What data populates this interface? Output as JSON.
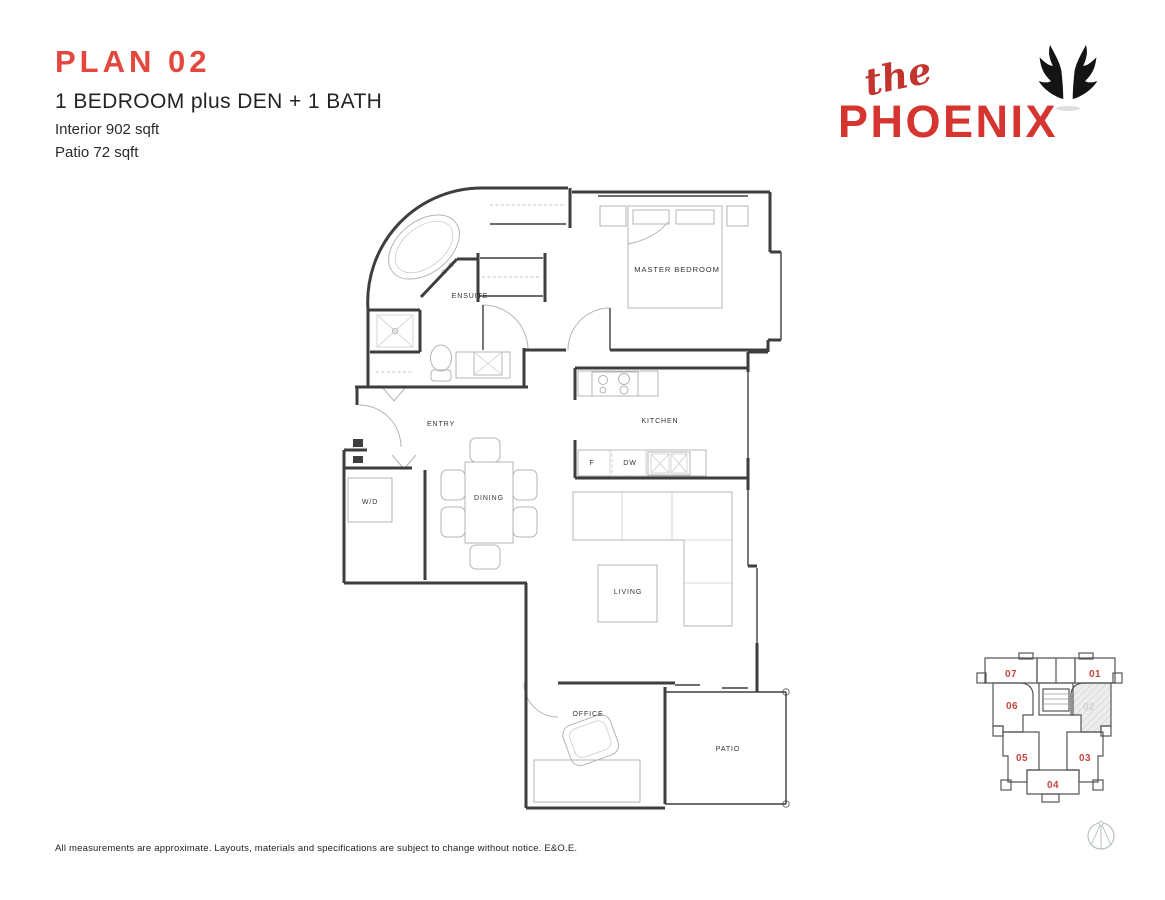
{
  "header": {
    "plan_title": "PLAN 02",
    "subtitle": "1 BEDROOM plus DEN + 1 BATH",
    "interior": "Interior 902 sqft",
    "patio": "Patio 72 sqft"
  },
  "logo": {
    "prefix": "the",
    "name": "PHOENIX",
    "wings_icon": "phoenix-wings-icon"
  },
  "floorplan": {
    "rooms": {
      "ensuite": "ENSUITE",
      "master_bedroom": "MASTER BEDROOM",
      "entry": "ENTRY",
      "kitchen": "KITCHEN",
      "fridge": "F",
      "dishwasher": "DW",
      "washer_dryer": "W/D",
      "dining": "DINING",
      "living": "LIVING",
      "office": "OFFICE",
      "patio": "PATIO"
    }
  },
  "keyplan": {
    "highlighted_unit": "02",
    "units": [
      {
        "number": "07"
      },
      {
        "number": "01"
      },
      {
        "number": "06"
      },
      {
        "number": "02"
      },
      {
        "number": "05"
      },
      {
        "number": "03"
      },
      {
        "number": "04"
      }
    ]
  },
  "footer": {
    "disclaimer": "All measurements are approximate. Layouts, materials and specifications are subject to change without notice. E&O.E."
  },
  "colors": {
    "accent_red": "#d6352f",
    "title_red": "#e2483d",
    "script_red": "#c2342f",
    "keyplan_red": "#c2453f",
    "wall_dark": "#3e3e3e",
    "furniture_gray": "#b4b4b4"
  }
}
